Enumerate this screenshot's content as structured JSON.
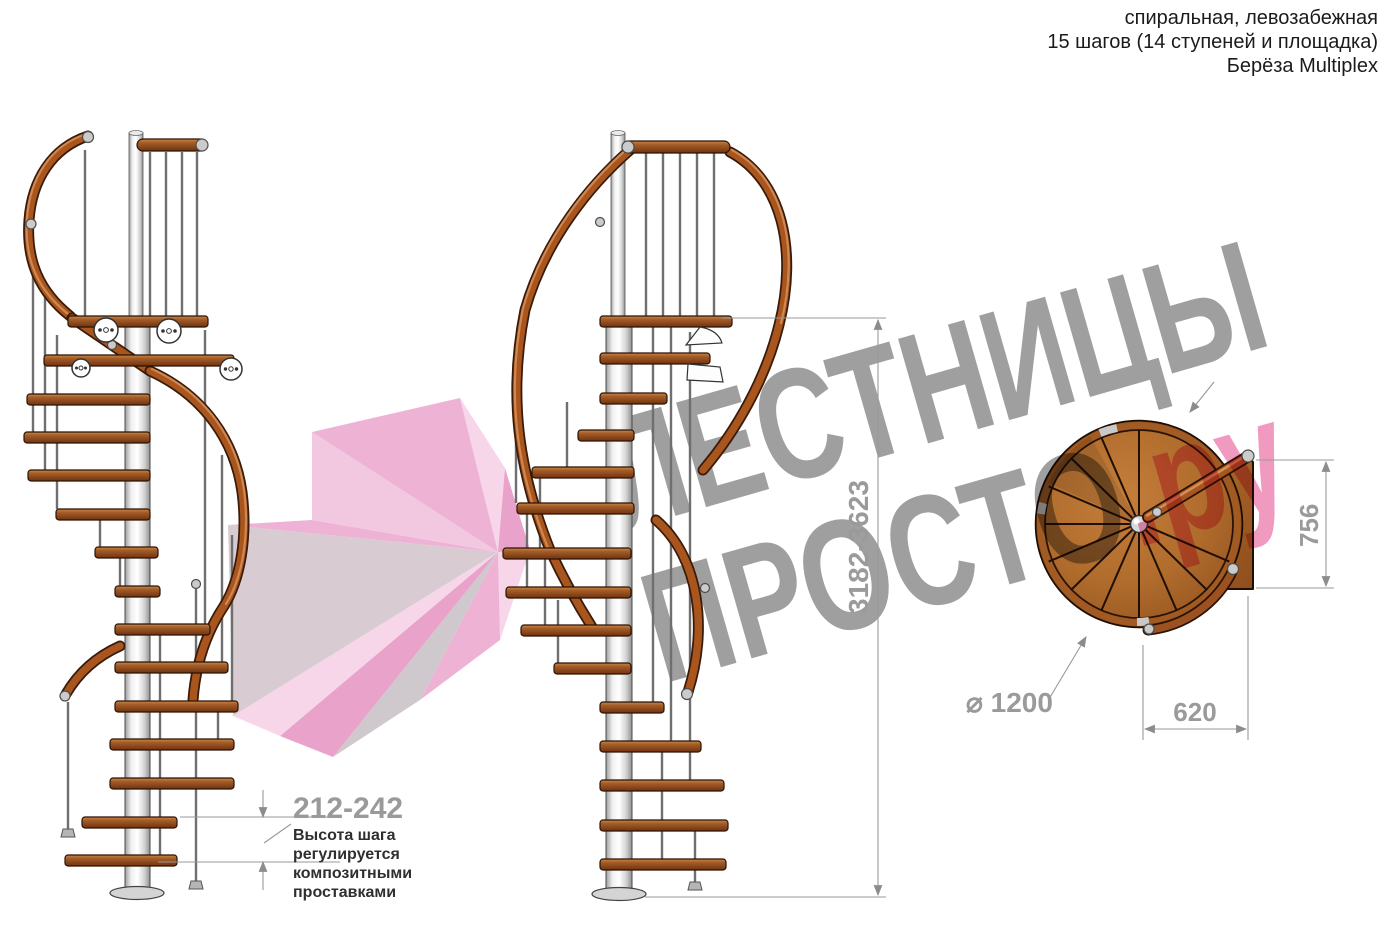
{
  "title": {
    "lines": [
      "спиральная, левозабежная",
      "15 шагов (14 ступеней и площадка)",
      "Берёза Multiplex"
    ]
  },
  "watermark": {
    "line1": "ЛЕСТНИЦЫ",
    "line2": "ПРОСТО",
    "suffix": ".ру"
  },
  "dimensions": {
    "step_height": "212-242",
    "total_height": "3182-3623",
    "landing_depth": "756",
    "diameter": "⌀ 1200",
    "landing_width": "620"
  },
  "note": {
    "lines": [
      "Высота шага",
      "регулируется",
      "композитными",
      "проставками"
    ]
  },
  "colors": {
    "wood": "#a8551e",
    "metal": "#cbcbcb",
    "dimension_gray": "#9a9a9a",
    "watermark_gray": "#9f9f9f",
    "watermark_pink": "#f09ac0"
  }
}
